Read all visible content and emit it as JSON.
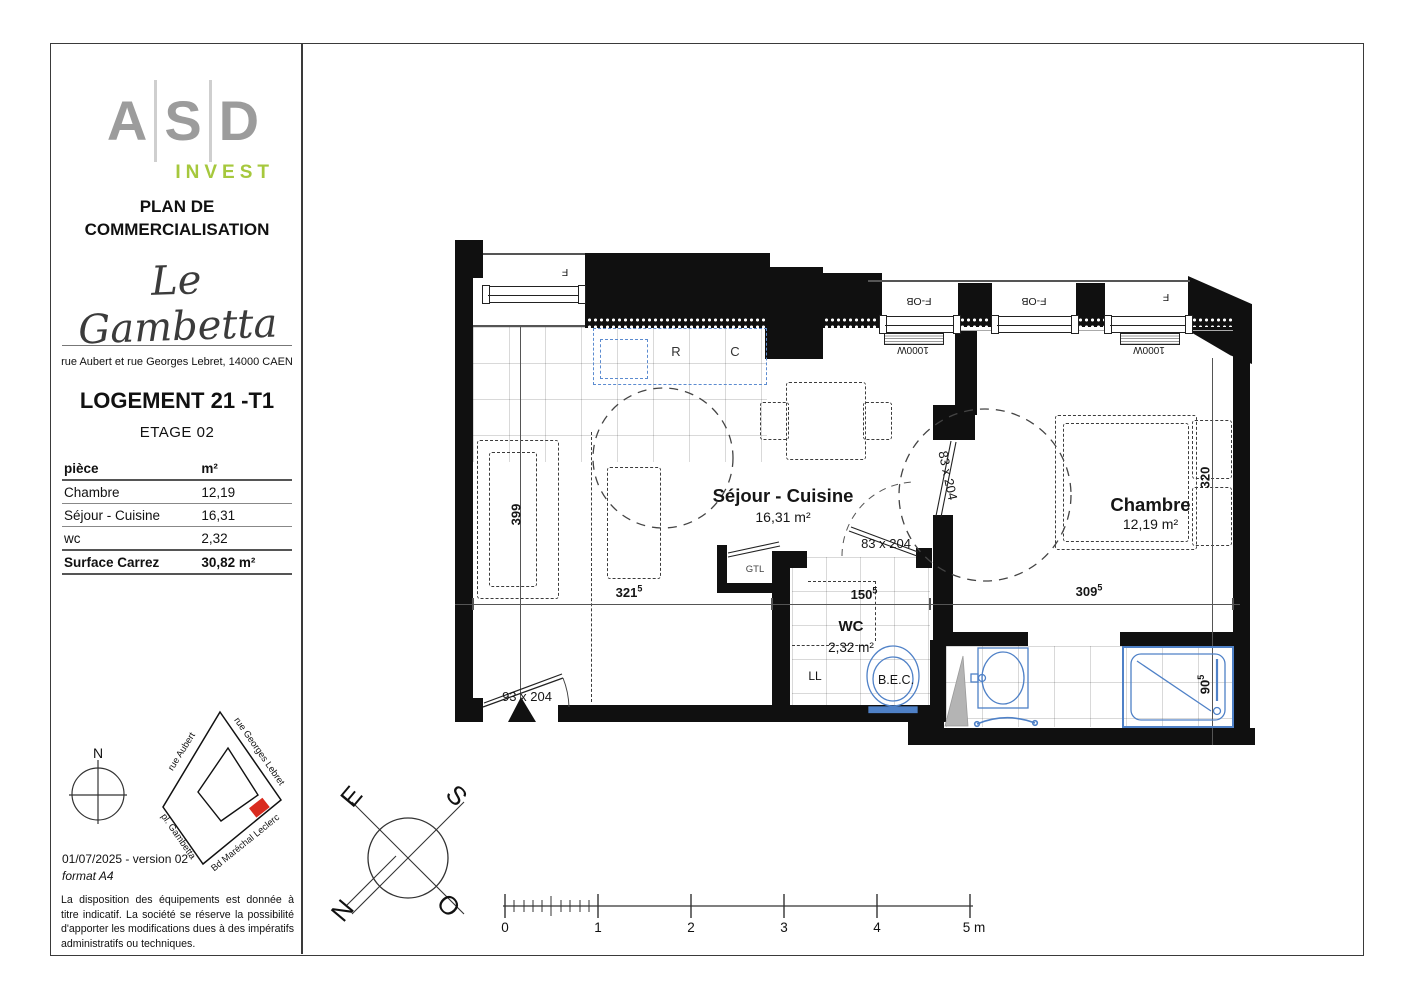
{
  "sidebar": {
    "logo_letters": {
      "a": "A",
      "s": "S",
      "d": "D"
    },
    "logo_sub": "INVEST",
    "doc_title": "PLAN DE COMMERCIALISATION",
    "residence": "Le Gambetta",
    "address": "rue Aubert et rue Georges Lebret, 14000 CAEN",
    "unit": "LOGEMENT 21 -T1",
    "floor": "ETAGE 02",
    "table": {
      "col_piece": "pièce",
      "col_area": "m²",
      "rows": [
        {
          "piece": "Chambre",
          "area": "12,19"
        },
        {
          "piece": "Séjour - Cuisine",
          "area": "16,31"
        },
        {
          "piece": "wc",
          "area": "2,32"
        }
      ],
      "total_label": "Surface Carrez",
      "total_area": "30,82 m²"
    },
    "north": "N",
    "map_streets": {
      "aubert": "rue Aubert",
      "lebret": "rue Georges Lebret",
      "gambetta": "pl. Gambetta",
      "leclerc": "Bd Maréchal Leclerc"
    },
    "version": "01/07/2025 - version 02",
    "format": "format A4",
    "disclaimer": "La disposition des équipements est donnée à titre indicatif. La société se réserve la possibilité d'apporter les modifications dues à des impératifs administratifs ou techniques."
  },
  "plan": {
    "sejour": {
      "name": "Séjour - Cuisine",
      "area": "16,31 m²"
    },
    "chambre": {
      "name": "Chambre",
      "area": "12,19 m²"
    },
    "wc": {
      "name": "WC",
      "area": "2,32 m²"
    },
    "gtl": "GTL",
    "ll": "LL",
    "bec": "B.E.C.",
    "fridge": "R",
    "cook": "C",
    "windows": {
      "w1": "F",
      "w2": "F-OB",
      "w3": "F-OB",
      "w4": "F"
    },
    "radiators": {
      "r1": "1000W",
      "r2": "1000W"
    },
    "doors": {
      "entrance": "93 x 204",
      "wc_door": "83 x 204",
      "chambre_door": "83 x 204"
    },
    "dims": {
      "left": "399",
      "h1": {
        "v": "321",
        "sup": "5"
      },
      "h2": {
        "v": "150",
        "sup": "5"
      },
      "h3": {
        "v": "309",
        "sup": "5"
      },
      "right": "320",
      "shower": {
        "v": "90",
        "sup": "5"
      }
    }
  },
  "compass": {
    "e": "E",
    "s": "S",
    "n": "N",
    "o": "O"
  },
  "scalebar": {
    "t0": "0",
    "t1": "1",
    "t2": "2",
    "t3": "3",
    "t4": "4",
    "t5": "5 m"
  },
  "colors": {
    "accent_green": "#a6c83d",
    "fixture_blue": "#4f81c7",
    "marker_red": "#d92b1f"
  }
}
